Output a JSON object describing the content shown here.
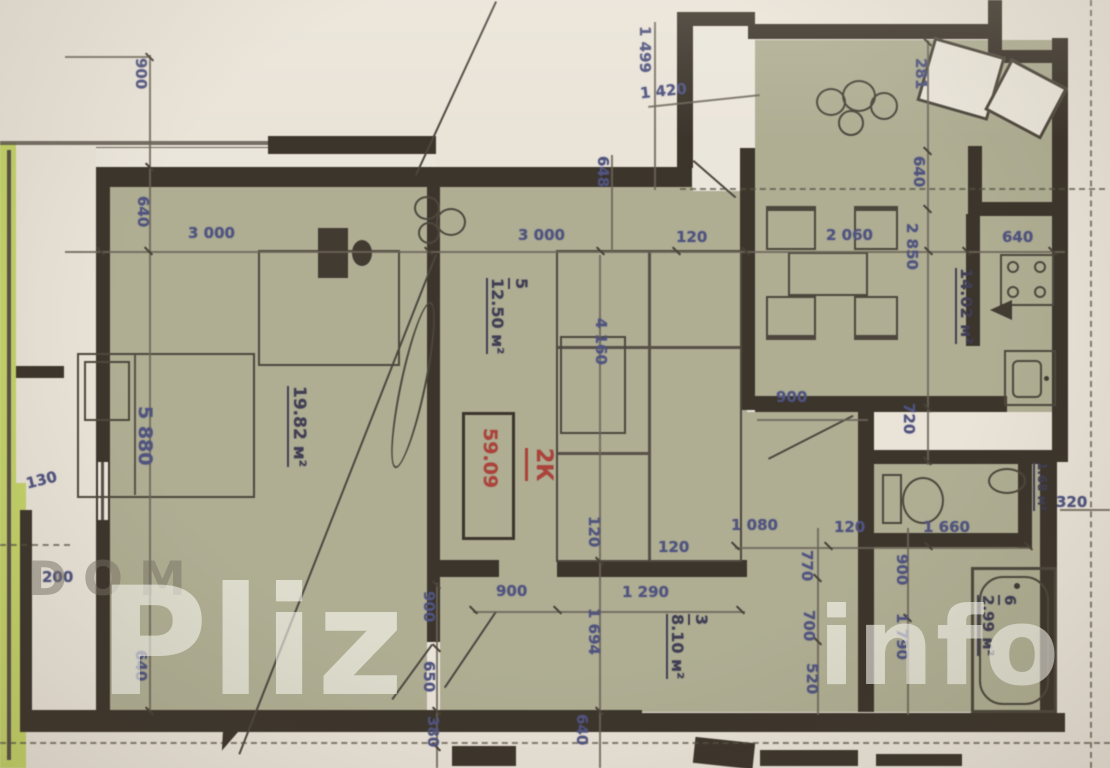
{
  "watermark": {
    "dom": "DOM",
    "pliz": "Pliz",
    "info": "info"
  },
  "apartment_label": {
    "type": "2К",
    "total_area": "59.09"
  },
  "rooms": {
    "bedroom": {
      "area": "19.82 м²"
    },
    "living": {
      "number": "5",
      "area": "12.50 м²"
    },
    "hallway": {
      "number": "3",
      "area": "8.10 м²"
    },
    "kitchen": {
      "area": "14.02 м²"
    },
    "wc": {
      "area": "1.68 м²"
    },
    "bathroom": {
      "number": "6",
      "area": "2.99 м²"
    }
  },
  "dims": {
    "bed_w": "3 000",
    "liv_w": "3 000",
    "wall_top": "120",
    "hall_w": "2 060",
    "kit_win": "640",
    "hall_door": "900",
    "chain_1080": "1 080",
    "chain_120": "120",
    "chain_1660": "1 660",
    "axis_320": "320",
    "liv_door": "900",
    "hall_1290": "1 290",
    "small_120": "120",
    "left_200": "200",
    "left_130": "130",
    "top_1420": "1 420",
    "tl_900": "900",
    "l_640a": "640",
    "bed_h": "5 880",
    "l_640b": "640",
    "b_1499": "1 499",
    "b_648": "648",
    "b_4160": "4 160",
    "b_1694": "1 694",
    "bl_900": "900",
    "bl_650": "650",
    "bl_380": "380",
    "bot_640": "640",
    "v_120": "120",
    "r_281": "281",
    "r_640": "640",
    "r_2850": "2 850",
    "r_720": "720",
    "c_770": "770",
    "c_700": "700",
    "c_520": "520",
    "bath_900": "900",
    "bath_1790": "1 790"
  }
}
